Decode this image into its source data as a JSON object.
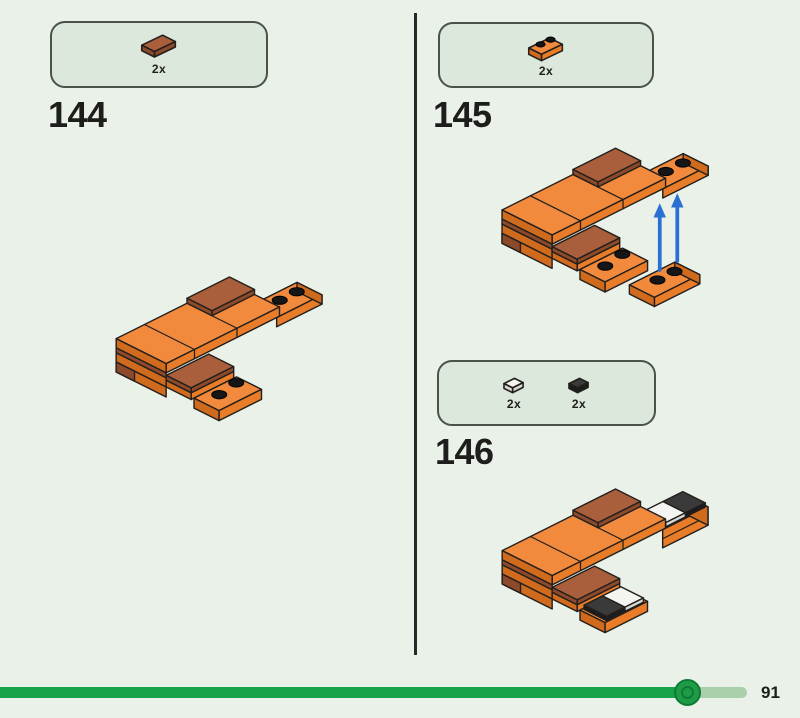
{
  "app": {
    "description": "LEGO building instructions page"
  },
  "steps": [
    {
      "number": "144",
      "parts": [
        {
          "name": "reddish-brown 1x2 tile",
          "count": "2x"
        }
      ]
    },
    {
      "number": "145",
      "parts": [
        {
          "name": "orange 1x2 plate",
          "count": "2x"
        }
      ]
    },
    {
      "number": "146",
      "parts": [
        {
          "name": "white 1x1 tile",
          "count": "2x"
        },
        {
          "name": "black 1x1 tile",
          "count": "2x"
        }
      ]
    }
  ],
  "progress": {
    "page_label": "91",
    "percent_complete": 92
  },
  "colors": {
    "page_bg": "#e9f1e9",
    "panel_bg": "#dde8dd",
    "panel_border": "#4a524b",
    "text": "#1d1d1b",
    "divider": "#26292a",
    "outline": "#231f1c",
    "orange_top": "#f18a3d",
    "orange_front": "#e87c28",
    "orange_side": "#d06a1d",
    "brown_top": "#a95f3b",
    "brown_side": "#8c4a2b",
    "white_part": "#f4f4f0",
    "white_part_side": "#d9d9d4",
    "black_part": "#3a3a3a",
    "black_part_side": "#1c1c1c",
    "stud_black": "#161616",
    "arrow_blue": "#2a70d3",
    "progress_fill": "#17a349",
    "progress_track": "#aacfab",
    "knob_fill": "#1d9b46",
    "knob_ring": "#0e7b33"
  }
}
